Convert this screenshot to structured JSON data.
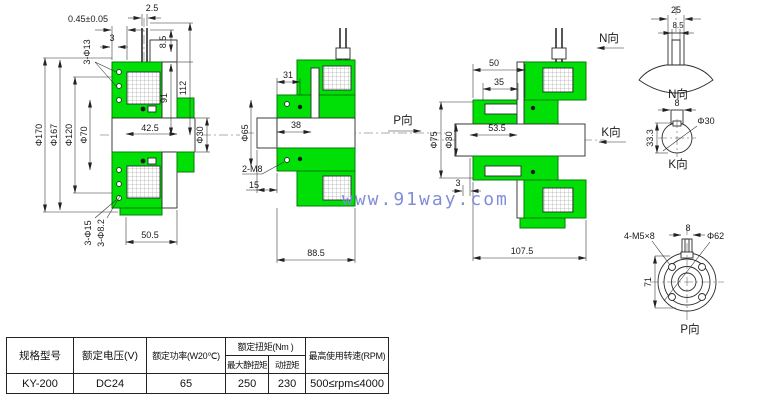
{
  "watermark": "www.91way.com",
  "d": {
    "v1": {
      "tol": "0.45±0.05",
      "p25": "2.5",
      "h13": "3-Φ13",
      "t3": "3",
      "p85": "8.5",
      "h112": "112",
      "h91": "91",
      "f170": "Φ170",
      "f167": "Φ167",
      "f120": "Φ120",
      "f70": "Φ70",
      "f30": "Φ30",
      "w425": "42.5",
      "h15": "3-Φ15",
      "h82": "3-Φ8.2",
      "w505": "50.5"
    },
    "v2": {
      "w31": "31",
      "w38": "38",
      "f65": "Φ65",
      "m8": "2-M8",
      "w15": "15",
      "w885": "88.5"
    },
    "v3": {
      "w50": "50",
      "w35": "35",
      "w535": "53.5",
      "f75": "Φ75",
      "f30": "Φ30",
      "t3": "3",
      "w1075": "107.5"
    },
    "nd": {
      "w25": "25",
      "w85": "8.5",
      "title": "N向"
    },
    "kd": {
      "w8": "8",
      "h333": "33.3",
      "f30": "Φ30",
      "title": "K向"
    },
    "pd": {
      "screws": "4-M5×8",
      "w8": "8",
      "f62": "Φ62",
      "h71": "71",
      "title": "P向"
    },
    "arrows": {
      "n": "N向",
      "k": "K向",
      "p": "P向"
    }
  },
  "table": {
    "headers": {
      "model": "规格型号",
      "voltage": "额定电压(V)",
      "power": "额定功率(W20℃)",
      "torque": "额定扭矩(Nm )",
      "static_torque": "最大静扭矩",
      "dynamic_torque": "动扭矩",
      "speed": "最高使用转速(RPM)"
    },
    "row": {
      "model": "KY-200",
      "voltage": "DC24",
      "power": "65",
      "static_torque": "250",
      "dynamic_torque": "230",
      "speed": "500≤rpm≤4000"
    }
  },
  "colors": {
    "green": "#00e007",
    "line": "#2b2b2b",
    "watermark": "#7c87d8"
  }
}
